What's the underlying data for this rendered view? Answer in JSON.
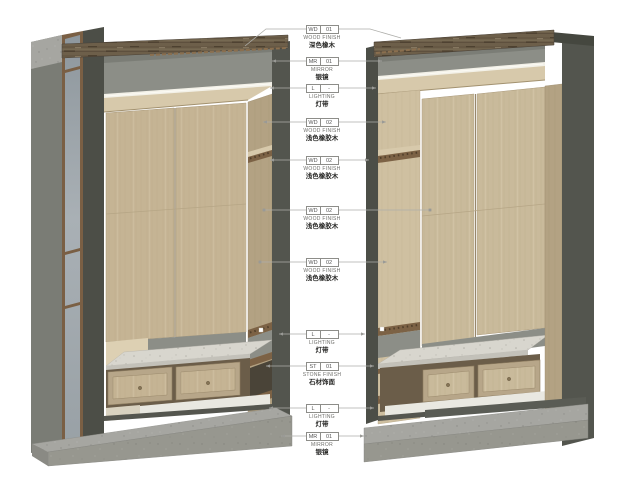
{
  "drawing": {
    "description": "Axonometric detail views of two wardrobe cabinet units with material callout annotations",
    "views": [
      "left wardrobe axonometric view",
      "right wardrobe axonometric view"
    ]
  },
  "colors": {
    "wood_light": "#c6b596",
    "wood_side": "#b5a485",
    "wood_top_dark": "#6d5f4a",
    "wood_trim": "#7c6245",
    "stone": "#d8d6ce",
    "concrete_base": "#a6a6a1",
    "mirror": "#9aa3a9",
    "frame_dark": "#4c4e47",
    "recess_gray": "#8c8e87",
    "led_light": "#f5f3ea",
    "leader_line": "#aeaeaa"
  },
  "callouts": [
    {
      "code": "WD",
      "num": "01",
      "label": "WOOD FINISH",
      "label_cn": "深色橡木",
      "y": 29,
      "left": [
        [
          306,
          29
        ],
        [
          266,
          29
        ],
        [
          245,
          46
        ]
      ],
      "right": [
        [
          338,
          29
        ],
        [
          370,
          29
        ],
        [
          401,
          38
        ]
      ],
      "end_left": "none",
      "end_right": "none"
    },
    {
      "code": "MR",
      "num": "01",
      "label": "MIRROR",
      "label_cn": "银镜",
      "y": 61,
      "left": [
        [
          306,
          61
        ],
        [
          272,
          61
        ]
      ],
      "right": [
        [
          338,
          61
        ],
        [
          382,
          61
        ]
      ],
      "end_left": "arrow",
      "end_right": "arrow"
    },
    {
      "code": "L",
      "num": "-",
      "label": "LIGHTING",
      "label_cn": "灯带",
      "y": 88,
      "left": [
        [
          306,
          88
        ],
        [
          270,
          88
        ]
      ],
      "right": [
        [
          338,
          88
        ],
        [
          376,
          88
        ]
      ],
      "end_left": "arrow",
      "end_right": "arrow"
    },
    {
      "code": "WD",
      "num": "02",
      "label": "WOOD FINISH",
      "label_cn": "浅色橡胶木",
      "y": 122,
      "left": [
        [
          306,
          122
        ],
        [
          263,
          122
        ]
      ],
      "right": [
        [
          338,
          122
        ],
        [
          386,
          122
        ]
      ],
      "end_left": "arrow",
      "end_right": "arrow"
    },
    {
      "code": "WD",
      "num": "02",
      "label": "WOOD FINISH",
      "label_cn": "浅色橡胶木",
      "y": 160,
      "left": [
        [
          306,
          160
        ],
        [
          270,
          160
        ]
      ],
      "right": [
        [
          338,
          160
        ],
        [
          369,
          160
        ]
      ],
      "end_left": "arrow",
      "end_right": "arrow"
    },
    {
      "code": "WD",
      "num": "02",
      "label": "WOOD FINISH",
      "label_cn": "浅色橡胶木",
      "y": 210,
      "left": [
        [
          306,
          210
        ],
        [
          264,
          210
        ]
      ],
      "right": [
        [
          338,
          210
        ],
        [
          430,
          210
        ]
      ],
      "end_left": "dot",
      "end_right": "dot"
    },
    {
      "code": "WD",
      "num": "02",
      "label": "WOOD FINISH",
      "label_cn": "浅色橡胶木",
      "y": 262,
      "left": [
        [
          306,
          262
        ],
        [
          260,
          262
        ]
      ],
      "right": [
        [
          338,
          262
        ],
        [
          387,
          262
        ]
      ],
      "end_left": "dot",
      "end_right": "arrow"
    },
    {
      "code": "L",
      "num": "-",
      "label": "LIGHTING",
      "label_cn": "灯带",
      "y": 334,
      "left": [
        [
          306,
          334
        ],
        [
          279,
          334
        ]
      ],
      "right": [
        [
          338,
          334
        ],
        [
          365,
          334
        ]
      ],
      "end_left": "arrow",
      "end_right": "arrow"
    },
    {
      "code": "ST",
      "num": "01",
      "label": "STONE FINISH",
      "label_cn": "石材饰面",
      "y": 366,
      "left": [
        [
          306,
          366
        ],
        [
          266,
          366
        ]
      ],
      "right": [
        [
          338,
          366
        ],
        [
          374,
          366
        ]
      ],
      "end_left": "arrow",
      "end_right": "arrow"
    },
    {
      "code": "L",
      "num": "-",
      "label": "LIGHTING",
      "label_cn": "灯带",
      "y": 408,
      "left": [
        [
          306,
          408
        ],
        [
          269,
          408
        ]
      ],
      "right": [
        [
          338,
          408
        ],
        [
          374,
          408
        ]
      ],
      "end_left": "arrow",
      "end_right": "arrow"
    },
    {
      "code": "MR",
      "num": "01",
      "label": "MIRROR",
      "label_cn": "银镜",
      "y": 436,
      "left": [
        [
          306,
          436
        ],
        [
          281,
          436
        ]
      ],
      "right": [
        [
          338,
          436
        ],
        [
          364,
          436
        ]
      ],
      "end_left": "arrow",
      "end_right": "arrow"
    }
  ]
}
